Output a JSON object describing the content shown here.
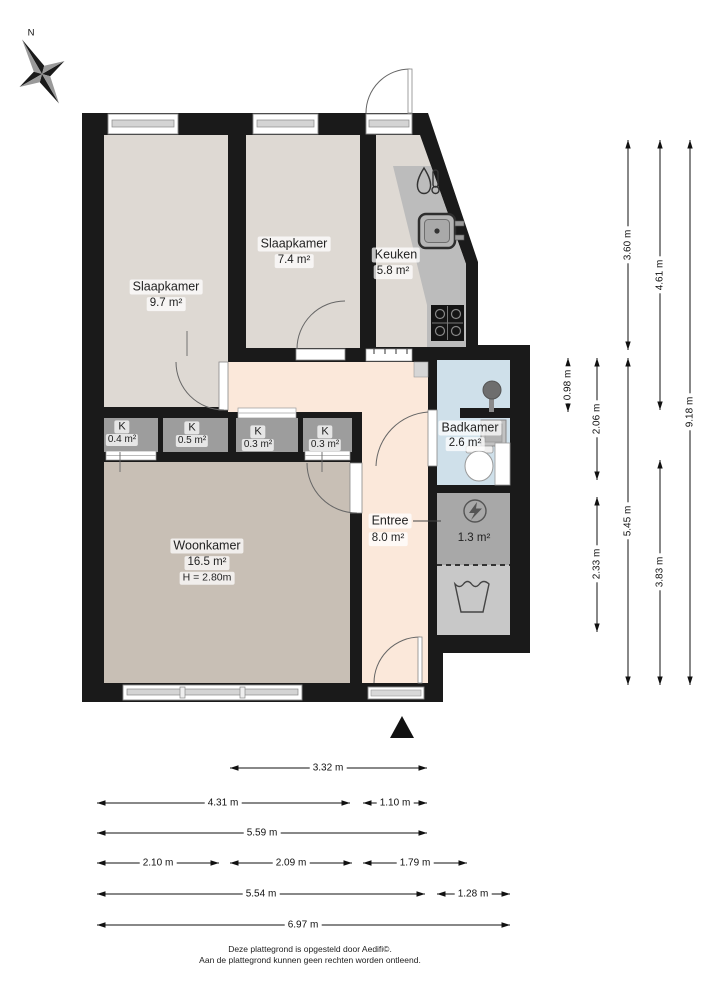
{
  "compass": {
    "north_label": "N"
  },
  "rooms": {
    "slaapkamer1": {
      "name": "Slaapkamer",
      "area": "9.7 m²"
    },
    "slaapkamer2": {
      "name": "Slaapkamer",
      "area": "7.4 m²"
    },
    "keuken": {
      "name": "Keuken",
      "area": "5.8 m²"
    },
    "badkamer": {
      "name": "Badkamer",
      "area": "2.6 m²"
    },
    "entree": {
      "name": "Entree",
      "area": "8.0 m²"
    },
    "woonkamer": {
      "name": "Woonkamer",
      "area": "16.5 m²",
      "ceiling_height": "H = 2.80m"
    },
    "kast1": {
      "name": "K",
      "area": "0.4 m²"
    },
    "kast2": {
      "name": "K",
      "area": "0.5 m²"
    },
    "kast3": {
      "name": "K",
      "area": "0.3 m²"
    },
    "kast4": {
      "name": "K",
      "area": "0.3 m²"
    },
    "techniek": {
      "area": "1.3 m²"
    }
  },
  "dims": {
    "v098": "0.98 m",
    "v206": "2.06 m",
    "v233": "2.33 m",
    "v360": "3.60 m",
    "v545": "5.45 m",
    "v461": "4.61 m",
    "v383": "3.83 m",
    "v918": "9.18 m",
    "h332": "3.32 m",
    "h431": "4.31 m",
    "h110": "1.10 m",
    "h559": "5.59 m",
    "h210": "2.10 m",
    "h209": "2.09 m",
    "h179": "1.79 m",
    "h554": "5.54 m",
    "h128": "1.28 m",
    "h697": "6.97 m"
  },
  "icons": {
    "compass": "compass-rose-icon",
    "water_heater": "water-heater-icon",
    "kitchen_sink": "sink-icon",
    "stove": "stove-icon",
    "shower": "shower-icon",
    "bathroom_sink": "washbasin-icon",
    "toilet": "toilet-icon",
    "electricity": "lightning-icon",
    "laundry": "laundry-tub-icon",
    "entrance_marker": "entrance-arrow-icon"
  },
  "colors": {
    "wall": "#1a1a1a",
    "bedroom_kitchen_floor": "#ded9d3",
    "living_floor": "#c8bfb5",
    "hall_floor": "#fbe8da",
    "bathroom_floor": "#cfe0ea",
    "closet_fill": "#9d9d9d",
    "counter_fill": "#bcbcbc",
    "tech_fill": "#a8a8a8",
    "laundry_fill": "#c8c8c8"
  },
  "footer": {
    "line1": "Deze plattegrond is opgesteld door Aedifi©.",
    "line2": "Aan de plattegrond kunnen geen rechten worden ontleend."
  }
}
